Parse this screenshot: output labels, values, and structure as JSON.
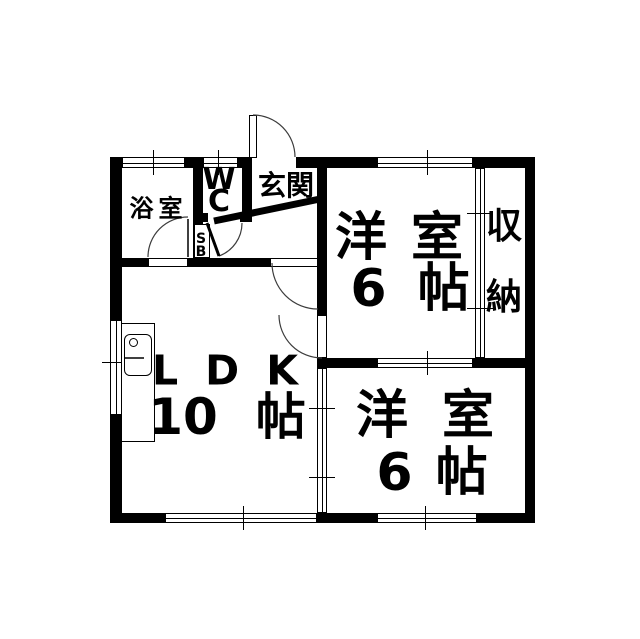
{
  "meta": {
    "width": 640,
    "height": 639,
    "background": "#ffffff",
    "wall_color": "#000000",
    "line_color": "#000000",
    "arc_color": "#3c3c3c"
  },
  "rooms": [
    {
      "name": "bathroom",
      "label": "浴室"
    },
    {
      "name": "toilet",
      "label": "WC"
    },
    {
      "name": "entrance",
      "label": "玄関"
    },
    {
      "name": "shoe-box",
      "label": "SB"
    },
    {
      "name": "bedroom-top",
      "label": "洋室 6帖"
    },
    {
      "name": "closet",
      "label": "収納"
    },
    {
      "name": "living-dining-kitchen",
      "label": "LDK 10帖"
    },
    {
      "name": "bedroom-bottom",
      "label": "洋室 6帖"
    }
  ],
  "labels": [
    {
      "name": "label-bathroom",
      "text": "浴室",
      "x": 156,
      "y": 206,
      "fs": 24,
      "ls": 5
    },
    {
      "name": "label-wc",
      "text": "W\nC",
      "x": 219,
      "y": 191,
      "fs": 30,
      "lh": 22,
      "stack": true
    },
    {
      "name": "label-entrance",
      "text": "玄関",
      "x": 286,
      "y": 184,
      "fs": 28,
      "ls": 0
    },
    {
      "name": "label-shoe-box",
      "text": "S\nB",
      "x": 201,
      "y": 246,
      "fs": 14,
      "lh": 13,
      "stack": true
    },
    {
      "name": "label-closet",
      "text": "収\n納",
      "x": 504,
      "y": 262,
      "fs": 36,
      "lh": 71,
      "stack": true
    },
    {
      "name": "label-bedroom1-name",
      "parts": [
        "洋",
        "室"
      ],
      "gap": 24,
      "x": 399,
      "y": 238,
      "fs": 52
    },
    {
      "name": "label-bedroom1-size",
      "parts": [
        "6",
        "帖"
      ],
      "gap": 31,
      "x": 410,
      "y": 289,
      "fs": 52
    },
    {
      "name": "label-ldk-name",
      "parts": [
        "L",
        "D",
        "K"
      ],
      "gap": 27,
      "x": 225,
      "y": 371,
      "fs": 41
    },
    {
      "name": "label-ldk-size",
      "parts": [
        "10",
        "帖"
      ],
      "gap": 38,
      "x": 227,
      "y": 417,
      "fs": 50
    },
    {
      "name": "label-bedroom2-name",
      "parts": [
        "洋",
        "室"
      ],
      "gap": 34,
      "x": 425,
      "y": 416,
      "fs": 52
    },
    {
      "name": "label-bedroom2-size",
      "parts": [
        "6",
        "帖"
      ],
      "gap": 23,
      "x": 432,
      "y": 473,
      "fs": 52
    }
  ],
  "plan": {
    "walls": [
      {
        "name": "wall-top-left-corner",
        "x": 110,
        "y": 157,
        "w": 12,
        "h": 11
      },
      {
        "name": "wall-top-bath-wc",
        "x": 185,
        "y": 157,
        "w": 18,
        "h": 11
      },
      {
        "name": "wall-top-wc-entrance",
        "x": 238,
        "y": 157,
        "w": 14,
        "h": 11
      },
      {
        "name": "wall-top-center",
        "x": 296,
        "y": 157,
        "w": 81,
        "h": 11
      },
      {
        "name": "wall-top-right",
        "x": 473,
        "y": 157,
        "w": 62,
        "h": 11
      },
      {
        "name": "wall-left-upper",
        "x": 110,
        "y": 157,
        "w": 12,
        "h": 163
      },
      {
        "name": "wall-left-lower",
        "x": 110,
        "y": 415,
        "w": 12,
        "h": 108
      },
      {
        "name": "wall-bottom-left",
        "x": 110,
        "y": 513,
        "w": 55,
        "h": 10
      },
      {
        "name": "wall-bottom-center",
        "x": 317,
        "y": 513,
        "w": 60,
        "h": 10
      },
      {
        "name": "wall-bottom-right",
        "x": 477,
        "y": 513,
        "w": 58,
        "h": 10
      },
      {
        "name": "wall-right",
        "x": 525,
        "y": 157,
        "w": 10,
        "h": 366
      },
      {
        "name": "wall-spine-upper",
        "x": 317,
        "y": 157,
        "w": 10,
        "h": 158
      },
      {
        "name": "wall-rooms-divider-left",
        "x": 317,
        "y": 358,
        "w": 60,
        "h": 10
      },
      {
        "name": "wall-rooms-divider-right",
        "x": 473,
        "y": 358,
        "w": 62,
        "h": 10
      },
      {
        "name": "wall-hall-ldk-left",
        "x": 110,
        "y": 258,
        "w": 38,
        "h": 9
      },
      {
        "name": "wall-hall-ldk-right",
        "x": 188,
        "y": 258,
        "w": 82,
        "h": 9
      },
      {
        "name": "wall-bath-wc",
        "x": 193,
        "y": 157,
        "w": 10,
        "h": 110
      },
      {
        "name": "wall-wc-right",
        "x": 242,
        "y": 157,
        "w": 10,
        "h": 65
      },
      {
        "name": "wall-wc-bottom-left",
        "x": 193,
        "y": 213,
        "w": 15,
        "h": 9
      },
      {
        "name": "wall-wc-bottom-right",
        "x": 240,
        "y": 213,
        "w": 12,
        "h": 9
      }
    ],
    "windows": [
      {
        "name": "window-bathroom",
        "x": 122,
        "y": 157,
        "w": 63,
        "h": 11,
        "o": "h",
        "ticks": [
          153
        ]
      },
      {
        "name": "window-wc",
        "x": 203,
        "y": 157,
        "w": 35,
        "h": 11,
        "o": "h",
        "ticks": [
          218
        ]
      },
      {
        "name": "window-bedroom1-top",
        "x": 377,
        "y": 157,
        "w": 96,
        "h": 11,
        "o": "h",
        "ticks": [
          427
        ]
      },
      {
        "name": "window-ldk-left",
        "x": 110,
        "y": 320,
        "w": 12,
        "h": 95,
        "o": "v",
        "ticks": [
          362
        ]
      },
      {
        "name": "window-ldk-bottom",
        "x": 165,
        "y": 513,
        "w": 152,
        "h": 10,
        "o": "h",
        "ticks": [
          243
        ]
      },
      {
        "name": "window-bedroom2-bottom",
        "x": 377,
        "y": 513,
        "w": 100,
        "h": 10,
        "o": "h",
        "ticks": [
          425
        ]
      },
      {
        "name": "slider-rooms-divider",
        "x": 377,
        "y": 358,
        "w": 96,
        "h": 10,
        "o": "h",
        "ticks": [
          427
        ]
      },
      {
        "name": "slider-ldk-bedroom2",
        "x": 317,
        "y": 368,
        "w": 10,
        "h": 145,
        "o": "v",
        "ticks": [
          408,
          477
        ]
      },
      {
        "name": "slider-closet",
        "x": 475,
        "y": 168,
        "w": 10,
        "h": 190,
        "o": "v",
        "ticks": [
          213,
          308
        ]
      }
    ],
    "door_leaves": [
      {
        "name": "entrance-door-leaf",
        "x": 249,
        "y": 115,
        "w": 8,
        "h": 43
      },
      {
        "name": "hall-ldk-door-leaf",
        "x": 270,
        "y": 258,
        "w": 48,
        "h": 9
      },
      {
        "name": "bedroom1-door-leaf",
        "x": 317,
        "y": 315,
        "w": 10,
        "h": 43
      },
      {
        "name": "bathroom-door-threshold",
        "x": 148,
        "y": 258,
        "w": 40,
        "h": 9
      }
    ],
    "fixtures": [
      {
        "name": "kitchen-counter",
        "x": 121,
        "y": 323,
        "w": 34,
        "h": 119,
        "r": 0,
        "bw": 1
      },
      {
        "name": "kitchen-sink",
        "x": 124,
        "y": 334,
        "w": 28,
        "h": 42,
        "r": 6,
        "bw": 1.5
      },
      {
        "name": "kitchen-faucet",
        "x": 129,
        "y": 338,
        "w": 9,
        "h": 9,
        "r": "50%",
        "bw": 1.5
      },
      {
        "name": "shoe-box",
        "x": 194,
        "y": 224,
        "w": 16,
        "h": 34,
        "r": 0,
        "bw": 1
      }
    ],
    "door_arcs": [
      {
        "name": "entrance-door-arc",
        "d": "M 253 115 A 42 42 0 0 1 295 157"
      },
      {
        "name": "hall-ldk-door-arc",
        "d": "M 272 263 A 46 46 0 0 0 318 309"
      },
      {
        "name": "bedroom1-door-arc",
        "d": "M 279 315 A 43 43 0 0 0 322 358"
      },
      {
        "name": "bathroom-door-arc",
        "d": "M 148 257 A 40 40 0 0 1 188 217"
      },
      {
        "name": "wc-door-arc",
        "d": "M 242 223 A 35 35 0 0 1 219 256"
      }
    ],
    "lines": [
      {
        "name": "wc-door-leaf-line",
        "x1": 207,
        "y1": 223,
        "x2": 219,
        "y2": 256,
        "w": 3
      },
      {
        "name": "bathroom-door-leaf-line",
        "x1": 188,
        "y1": 219,
        "x2": 188,
        "y2": 257,
        "w": 1.5
      },
      {
        "name": "entrance-step-line",
        "x1": 214,
        "y1": 221,
        "x2": 320,
        "y2": 199,
        "w": 7
      },
      {
        "name": "kitchen-faucet-line",
        "x1": 124,
        "y1": 358,
        "x2": 144,
        "y2": 358,
        "w": 1.5
      }
    ]
  }
}
